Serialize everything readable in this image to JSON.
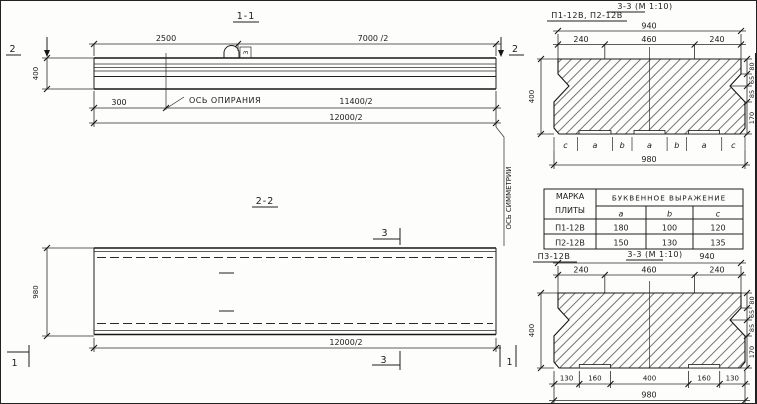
{
  "drawing": {
    "section_1_1": {
      "title": "1-1",
      "marker_left": "2",
      "marker_right": "2",
      "dim_top_1": "2500",
      "dim_top_2": "7000 /2",
      "dim_height": "400",
      "dim_overhang": "300",
      "support_axis_label": "ОСЬ ОПИРАНИЯ",
      "dim_bottom_1": "11400/2",
      "dim_bottom_2": "12000/2",
      "loop_tag": "3"
    },
    "section_2_2": {
      "title": "2-2",
      "dim_width": "980",
      "dim_length": "12000/2",
      "marker_3_top": "3",
      "marker_3_bottom": "3",
      "marker_1_left": "1",
      "marker_1_right": "1",
      "symmetry_axis_label": "ОСЬ СИММЕТРИИ"
    },
    "s33_top": {
      "label": "П1-12В, П2-12В",
      "title": "3-3 (М 1:10)",
      "dim_top_total": "940",
      "dims_top": [
        "240",
        "460",
        "240"
      ],
      "dim_left": "400",
      "dims_right": [
        "80",
        "65",
        "85",
        "170"
      ],
      "letters": [
        "c",
        "a",
        "b",
        "a",
        "b",
        "a",
        "c"
      ],
      "dim_bottom_total": "980"
    },
    "table": {
      "col1_line1": "МАРКА",
      "col1_line2": "ПЛИТЫ",
      "col2_header": "БУКВЕННОЕ  ВЫРАЖЕНИЕ",
      "sub_headers": [
        "a",
        "b",
        "c"
      ],
      "rows": [
        {
          "mark": "П1-12В",
          "a": "180",
          "b": "100",
          "c": "120"
        },
        {
          "mark": "П2-12В",
          "a": "150",
          "b": "130",
          "c": "135"
        }
      ]
    },
    "s33_bottom": {
      "label": "П3-12В",
      "title": "3-3 (М 1:10)",
      "dim_top_total": "940",
      "dims_top": [
        "240",
        "460",
        "240"
      ],
      "dim_left": "400",
      "dims_right": [
        "80",
        "65",
        "85",
        "170"
      ],
      "dims_bottom": [
        "130",
        "160",
        "400",
        "160",
        "130"
      ],
      "dim_bottom_total": "980"
    }
  }
}
